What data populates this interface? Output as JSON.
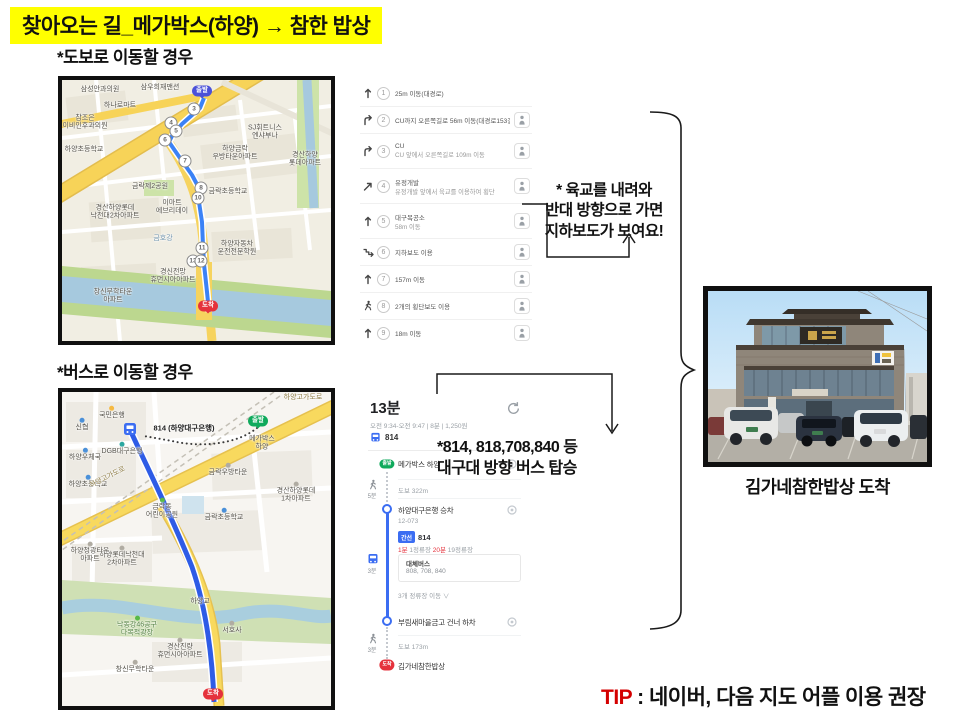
{
  "title": "찾아오는 길_메가박스(하양) → 참한 밥상",
  "walk": {
    "label": "*도보로 이동할 경우",
    "note": "* 육교를 내려와\n반대 방향으로 가면\n지하보도가 보여요!",
    "steps": [
      {
        "num": "1",
        "icon": "straight",
        "t1": "25m 이동(대경로)",
        "rv": false
      },
      {
        "num": "2",
        "icon": "turn-right",
        "t1": "CU까지 오른쪽길로 56m 이동(대경로153길)",
        "rv": true
      },
      {
        "num": "3",
        "icon": "turn-right",
        "t1": "CU",
        "t2": "CU 앞에서 오른쪽길로 109m 이동",
        "rv": true
      },
      {
        "num": "4",
        "icon": "diagonal-right",
        "t1": "유정개발",
        "t2": "유정개발 앞에서 육교를 이용하여 횡단",
        "rv": true
      },
      {
        "num": "5",
        "icon": "straight",
        "t1": "대구목공소",
        "t2": "58m 이동",
        "rv": true
      },
      {
        "num": "6",
        "icon": "underpass",
        "t1": "지하보도 이용",
        "rv": true
      },
      {
        "num": "7",
        "icon": "straight",
        "t1": "157m 이동",
        "rv": true
      },
      {
        "num": "8",
        "icon": "crosswalk",
        "t1": "2개의 횡단보도 이용",
        "rv": true
      },
      {
        "num": "9",
        "icon": "straight",
        "t1": "18m 이동",
        "rv": true
      }
    ]
  },
  "busSection": {
    "label": "*버스로 이동할 경우",
    "note1": "*814, 818,708,840 등",
    "note2": "대구대 방향 버스 탑승",
    "panel": {
      "duration": "13분",
      "meta": "오전 9:34-오전 9:47  |  8분  |  1,250원",
      "line": "814",
      "startMarker": "출발",
      "start": "메가박스 하양",
      "walk1": "도보 322m",
      "walk1Time": "5분",
      "board": "하양대구은행 승차",
      "boardNo": "12-073",
      "badge": "간선",
      "badgeLine": "814",
      "f1": "1분",
      "f1l": " 1정류장   ",
      "f2": "20분",
      "f2l": " 19정류장",
      "altTitle": "대체버스",
      "altList": "808, 708, 840",
      "toggle": "3개 정류장 이동  ∨",
      "rideTime": "3분",
      "alight": "부림새마을금고 건너 하차",
      "walk2": "도보 173m",
      "walk2Time": "3분",
      "destMarker": "도착",
      "dest": "김가네참한밥상"
    }
  },
  "photoCaption": "김가네참한밥상  도착",
  "tip": {
    "label": "TIP",
    "text": " : 네이버, 다음 지도 어플 이용 권장"
  },
  "map1": {
    "labels": [
      {
        "t": "삼성안과의원",
        "x": 38,
        "y": 10
      },
      {
        "t": "삼우희재맨션",
        "x": 98,
        "y": 8
      },
      {
        "t": "하나로마트",
        "x": 58,
        "y": 26
      },
      {
        "t": "참조은\n이비인후과의원",
        "x": 23,
        "y": 43
      },
      {
        "t": "하양초등학교",
        "x": 22,
        "y": 70
      },
      {
        "t": "SJ휘트니스\n엔샤부나",
        "x": 203,
        "y": 53
      },
      {
        "t": "하양금락\n우방타운아파트",
        "x": 173,
        "y": 74
      },
      {
        "t": "경산하양\n롯데아파트",
        "x": 243,
        "y": 80
      },
      {
        "t": "금락제2공원",
        "x": 88,
        "y": 107
      },
      {
        "t": "금락초등학교",
        "x": 166,
        "y": 112
      },
      {
        "t": "이마트\n에브리데이",
        "x": 110,
        "y": 128
      },
      {
        "t": "경산하양롯데\n낙천대2차아파트",
        "x": 53,
        "y": 133
      },
      {
        "t": "금호강",
        "x": 101,
        "y": 159,
        "cls": "water"
      },
      {
        "t": "하양자동차\n운전전문학원",
        "x": 175,
        "y": 169
      },
      {
        "t": "경신전망\n휴먼시아아파트",
        "x": 111,
        "y": 197
      },
      {
        "t": "창신무학타운\n아파트",
        "x": 51,
        "y": 217
      }
    ],
    "routeNums": [
      {
        "n": "3",
        "x": 132,
        "y": 29
      },
      {
        "n": "4",
        "x": 109,
        "y": 43
      },
      {
        "n": "5",
        "x": 114,
        "y": 51
      },
      {
        "n": "6",
        "x": 103,
        "y": 60
      },
      {
        "n": "7",
        "x": 123,
        "y": 81
      },
      {
        "n": "8",
        "x": 139,
        "y": 108
      },
      {
        "n": "10",
        "x": 136,
        "y": 118
      },
      {
        "n": "11",
        "x": 140,
        "y": 168
      },
      {
        "n": "13",
        "x": 131,
        "y": 181
      },
      {
        "n": "12",
        "x": 139,
        "y": 181
      }
    ],
    "pins": [
      {
        "t": "출발",
        "x": 140,
        "y": 16,
        "color": "blue"
      },
      {
        "t": "도착",
        "x": 146,
        "y": 231,
        "color": "red"
      }
    ]
  },
  "map2": {
    "labels": [
      {
        "t": "국민은행",
        "x": 50,
        "y": 21,
        "dot": "#f5b942"
      },
      {
        "t": "신협",
        "x": 20,
        "y": 33,
        "dot": "#4a90d9"
      },
      {
        "t": "하양우체국",
        "x": 23,
        "y": 63,
        "dot": "#4a90d9"
      },
      {
        "t": "하양초등학교",
        "x": 26,
        "y": 90,
        "dot": "#4a90d9"
      },
      {
        "t": "DGB대구은행",
        "x": 60,
        "y": 57,
        "dot": "#2aa7a0"
      },
      {
        "t": "814 (하양대구은행)",
        "x": 122,
        "y": 36,
        "cls": "busline"
      },
      {
        "t": "메가박스\n하양",
        "x": 200,
        "y": 52
      },
      {
        "t": "하양고가도로",
        "x": 241,
        "y": 6,
        "cls": "road"
      },
      {
        "t": "하양고가도로",
        "x": 46,
        "y": 86,
        "cls": "road",
        "r": -27
      },
      {
        "t": "금락우방타운",
        "x": 166,
        "y": 78,
        "dot": "#b0aca2"
      },
      {
        "t": "경산하양롯데\n1차아파트",
        "x": 234,
        "y": 101,
        "dot": "#b0aca2"
      },
      {
        "t": "금락동\n어린이공원",
        "x": 100,
        "y": 117,
        "dot": "#58b947"
      },
      {
        "t": "금락초등학교",
        "x": 162,
        "y": 123,
        "dot": "#4a90d9"
      },
      {
        "t": "하양롯데낙천대\n2차아파트",
        "x": 60,
        "y": 165,
        "dot": "#b0aca2"
      },
      {
        "t": "하양청광타운\n아파트",
        "x": 28,
        "y": 161,
        "dot": "#b0aca2"
      },
      {
        "t": "하양교",
        "x": 138,
        "y": 210
      },
      {
        "t": "낙동강46공구\n다목적광장",
        "x": 75,
        "y": 235,
        "cls": "park",
        "dot": "#58b947"
      },
      {
        "t": "서호사",
        "x": 170,
        "y": 236,
        "dot": "#b0aca2"
      },
      {
        "t": "경산진량\n휴먼시아아파트",
        "x": 118,
        "y": 257,
        "dot": "#b0aca2"
      },
      {
        "t": "창신무학타운",
        "x": 73,
        "y": 275,
        "dot": "#b0aca2"
      }
    ],
    "routeNums": [],
    "pins": [
      {
        "t": "출발",
        "x": 196,
        "y": 34,
        "color": "green"
      },
      {
        "t": "도착",
        "x": 151,
        "y": 307,
        "color": "red"
      }
    ]
  }
}
